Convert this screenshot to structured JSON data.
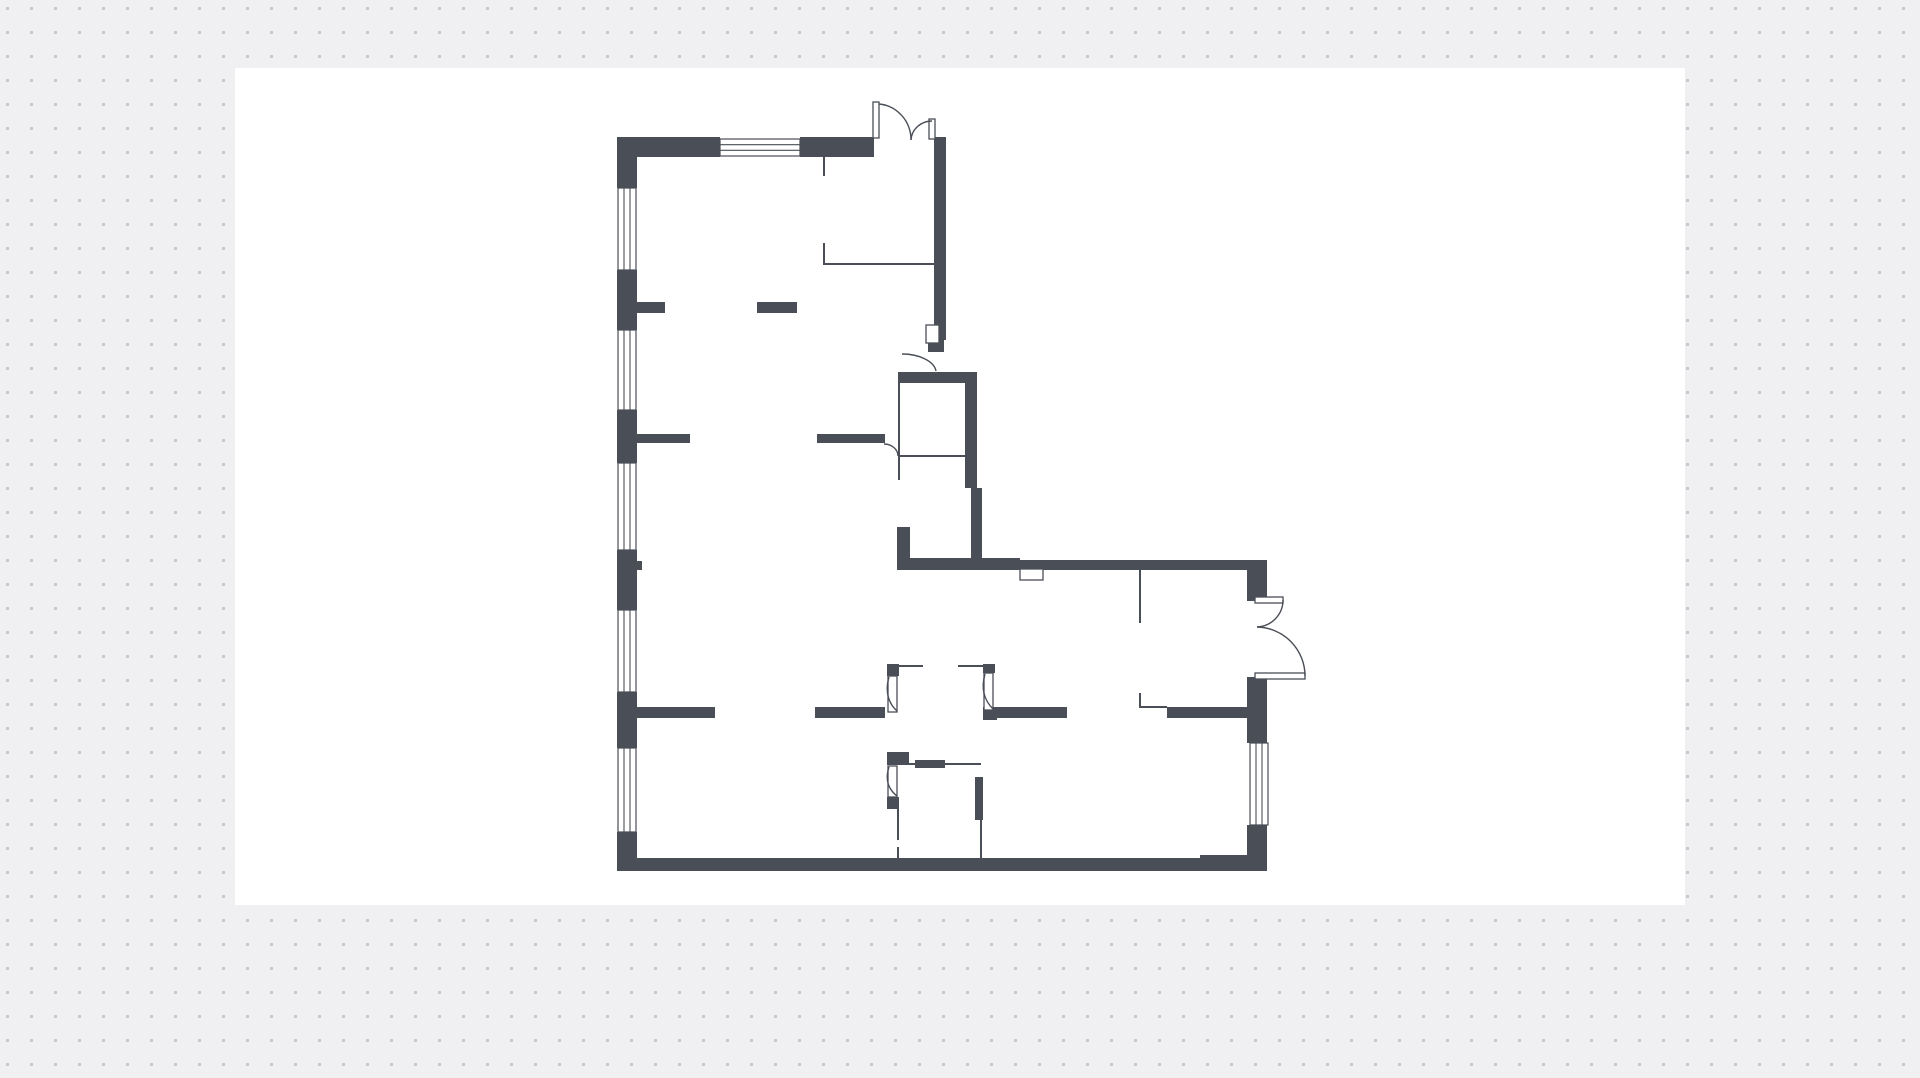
{
  "canvas": {
    "width": 1920,
    "height": 1078
  },
  "colors": {
    "page_bg": "#f0f0f2",
    "dot": "#c9c9cd",
    "paper": "#ffffff",
    "wall": "#4a4e57",
    "line": "#4a4e57"
  },
  "dot_grid": {
    "spacing": 24,
    "dot_size": 3,
    "dot_offset_x": 6,
    "dot_offset_y": 7
  },
  "paper_rect": {
    "x": 235,
    "y": 68,
    "w": 1450,
    "h": 837
  },
  "floor_plan": {
    "walls": [
      [
        617,
        137,
        20,
        51
      ],
      [
        617,
        270,
        20,
        60
      ],
      [
        617,
        410,
        20,
        53
      ],
      [
        617,
        550,
        20,
        60
      ],
      [
        617,
        692,
        20,
        56
      ],
      [
        617,
        832,
        20,
        39
      ],
      [
        617,
        137,
        103,
        20
      ],
      [
        800,
        137,
        74,
        20
      ],
      [
        934,
        137,
        12,
        188
      ],
      [
        937,
        325,
        9,
        15
      ],
      [
        928,
        340,
        16,
        12
      ],
      [
        637,
        302,
        28,
        11
      ],
      [
        757,
        302,
        40,
        11
      ],
      [
        637,
        434,
        53,
        9
      ],
      [
        817,
        434,
        68,
        9
      ],
      [
        898,
        372,
        79,
        11
      ],
      [
        965,
        383,
        12,
        72
      ],
      [
        965,
        455,
        12,
        33
      ],
      [
        971,
        488,
        11,
        75
      ],
      [
        897,
        527,
        13,
        41
      ],
      [
        897,
        558,
        123,
        12
      ],
      [
        897,
        560,
        350,
        10
      ],
      [
        1247,
        560,
        20,
        41
      ],
      [
        1247,
        677,
        20,
        66
      ],
      [
        1247,
        825,
        20,
        45
      ],
      [
        637,
        707,
        78,
        11
      ],
      [
        815,
        707,
        70,
        11
      ],
      [
        997,
        707,
        70,
        11
      ],
      [
        1167,
        707,
        83,
        11
      ],
      [
        887,
        664,
        12,
        12
      ],
      [
        983,
        664,
        12,
        9
      ],
      [
        887,
        752,
        22,
        13
      ],
      [
        887,
        797,
        12,
        12
      ],
      [
        915,
        760,
        30,
        8
      ],
      [
        975,
        777,
        8,
        43
      ],
      [
        983,
        707,
        14,
        13
      ],
      [
        637,
        858,
        563,
        13
      ],
      [
        1200,
        855,
        67,
        16
      ],
      [
        637,
        561,
        5,
        9
      ]
    ],
    "windows": [
      {
        "x": 618,
        "y": 188,
        "w": 18,
        "h": 82,
        "o": "v"
      },
      {
        "x": 618,
        "y": 330,
        "w": 18,
        "h": 80,
        "o": "v"
      },
      {
        "x": 618,
        "y": 463,
        "w": 18,
        "h": 87,
        "o": "v"
      },
      {
        "x": 618,
        "y": 610,
        "w": 18,
        "h": 82,
        "o": "v"
      },
      {
        "x": 618,
        "y": 748,
        "w": 18,
        "h": 84,
        "o": "v"
      },
      {
        "x": 720,
        "y": 139,
        "w": 80,
        "h": 17,
        "o": "h"
      },
      {
        "x": 1250,
        "y": 743,
        "w": 18,
        "h": 82,
        "o": "v"
      }
    ],
    "niches": [
      [
        926,
        325,
        13,
        18
      ],
      [
        1020,
        569,
        23,
        11
      ]
    ],
    "door_leaves": [
      [
        873,
        102,
        6,
        36
      ],
      [
        929,
        119,
        6,
        20
      ],
      [
        1255,
        597,
        28,
        6
      ],
      [
        1255,
        673,
        50,
        6
      ],
      [
        888,
        676,
        9,
        36
      ],
      [
        984,
        673,
        9,
        37
      ],
      [
        888,
        766,
        9,
        31
      ]
    ],
    "door_arcs": [
      "M879,104 A35,36 0 0 1 911,140",
      "M932,121 A21,20 0 0 0 911,140",
      "M1283,600 A27,27 0 0 1 1257,627",
      "M1305,676 A49,49 0 0 0 1257,627",
      "M902,354 A34,19 0 0 1 936,371",
      "M884,444 A14,12 0 0 1 898,456",
      "M889,677 C885,691 888,703 897,711",
      "M985,674 C981,688 984,700 993,709",
      "M889,767 C885,779 888,789 897,796"
    ],
    "thin_lines": [
      [
        824,
        157,
        824,
        176
      ],
      [
        824,
        243,
        824,
        265
      ],
      [
        824,
        264,
        934,
        264
      ],
      [
        899,
        383,
        899,
        480
      ],
      [
        899,
        456,
        965,
        456
      ],
      [
        1140,
        570,
        1140,
        623
      ],
      [
        1140,
        693,
        1140,
        708
      ],
      [
        1140,
        707,
        1167,
        707
      ],
      [
        899,
        666,
        923,
        666
      ],
      [
        958,
        666,
        983,
        666
      ],
      [
        899,
        764,
        981,
        764
      ],
      [
        898,
        809,
        898,
        840
      ],
      [
        898,
        847,
        898,
        861
      ],
      [
        981,
        820,
        981,
        858
      ]
    ]
  }
}
